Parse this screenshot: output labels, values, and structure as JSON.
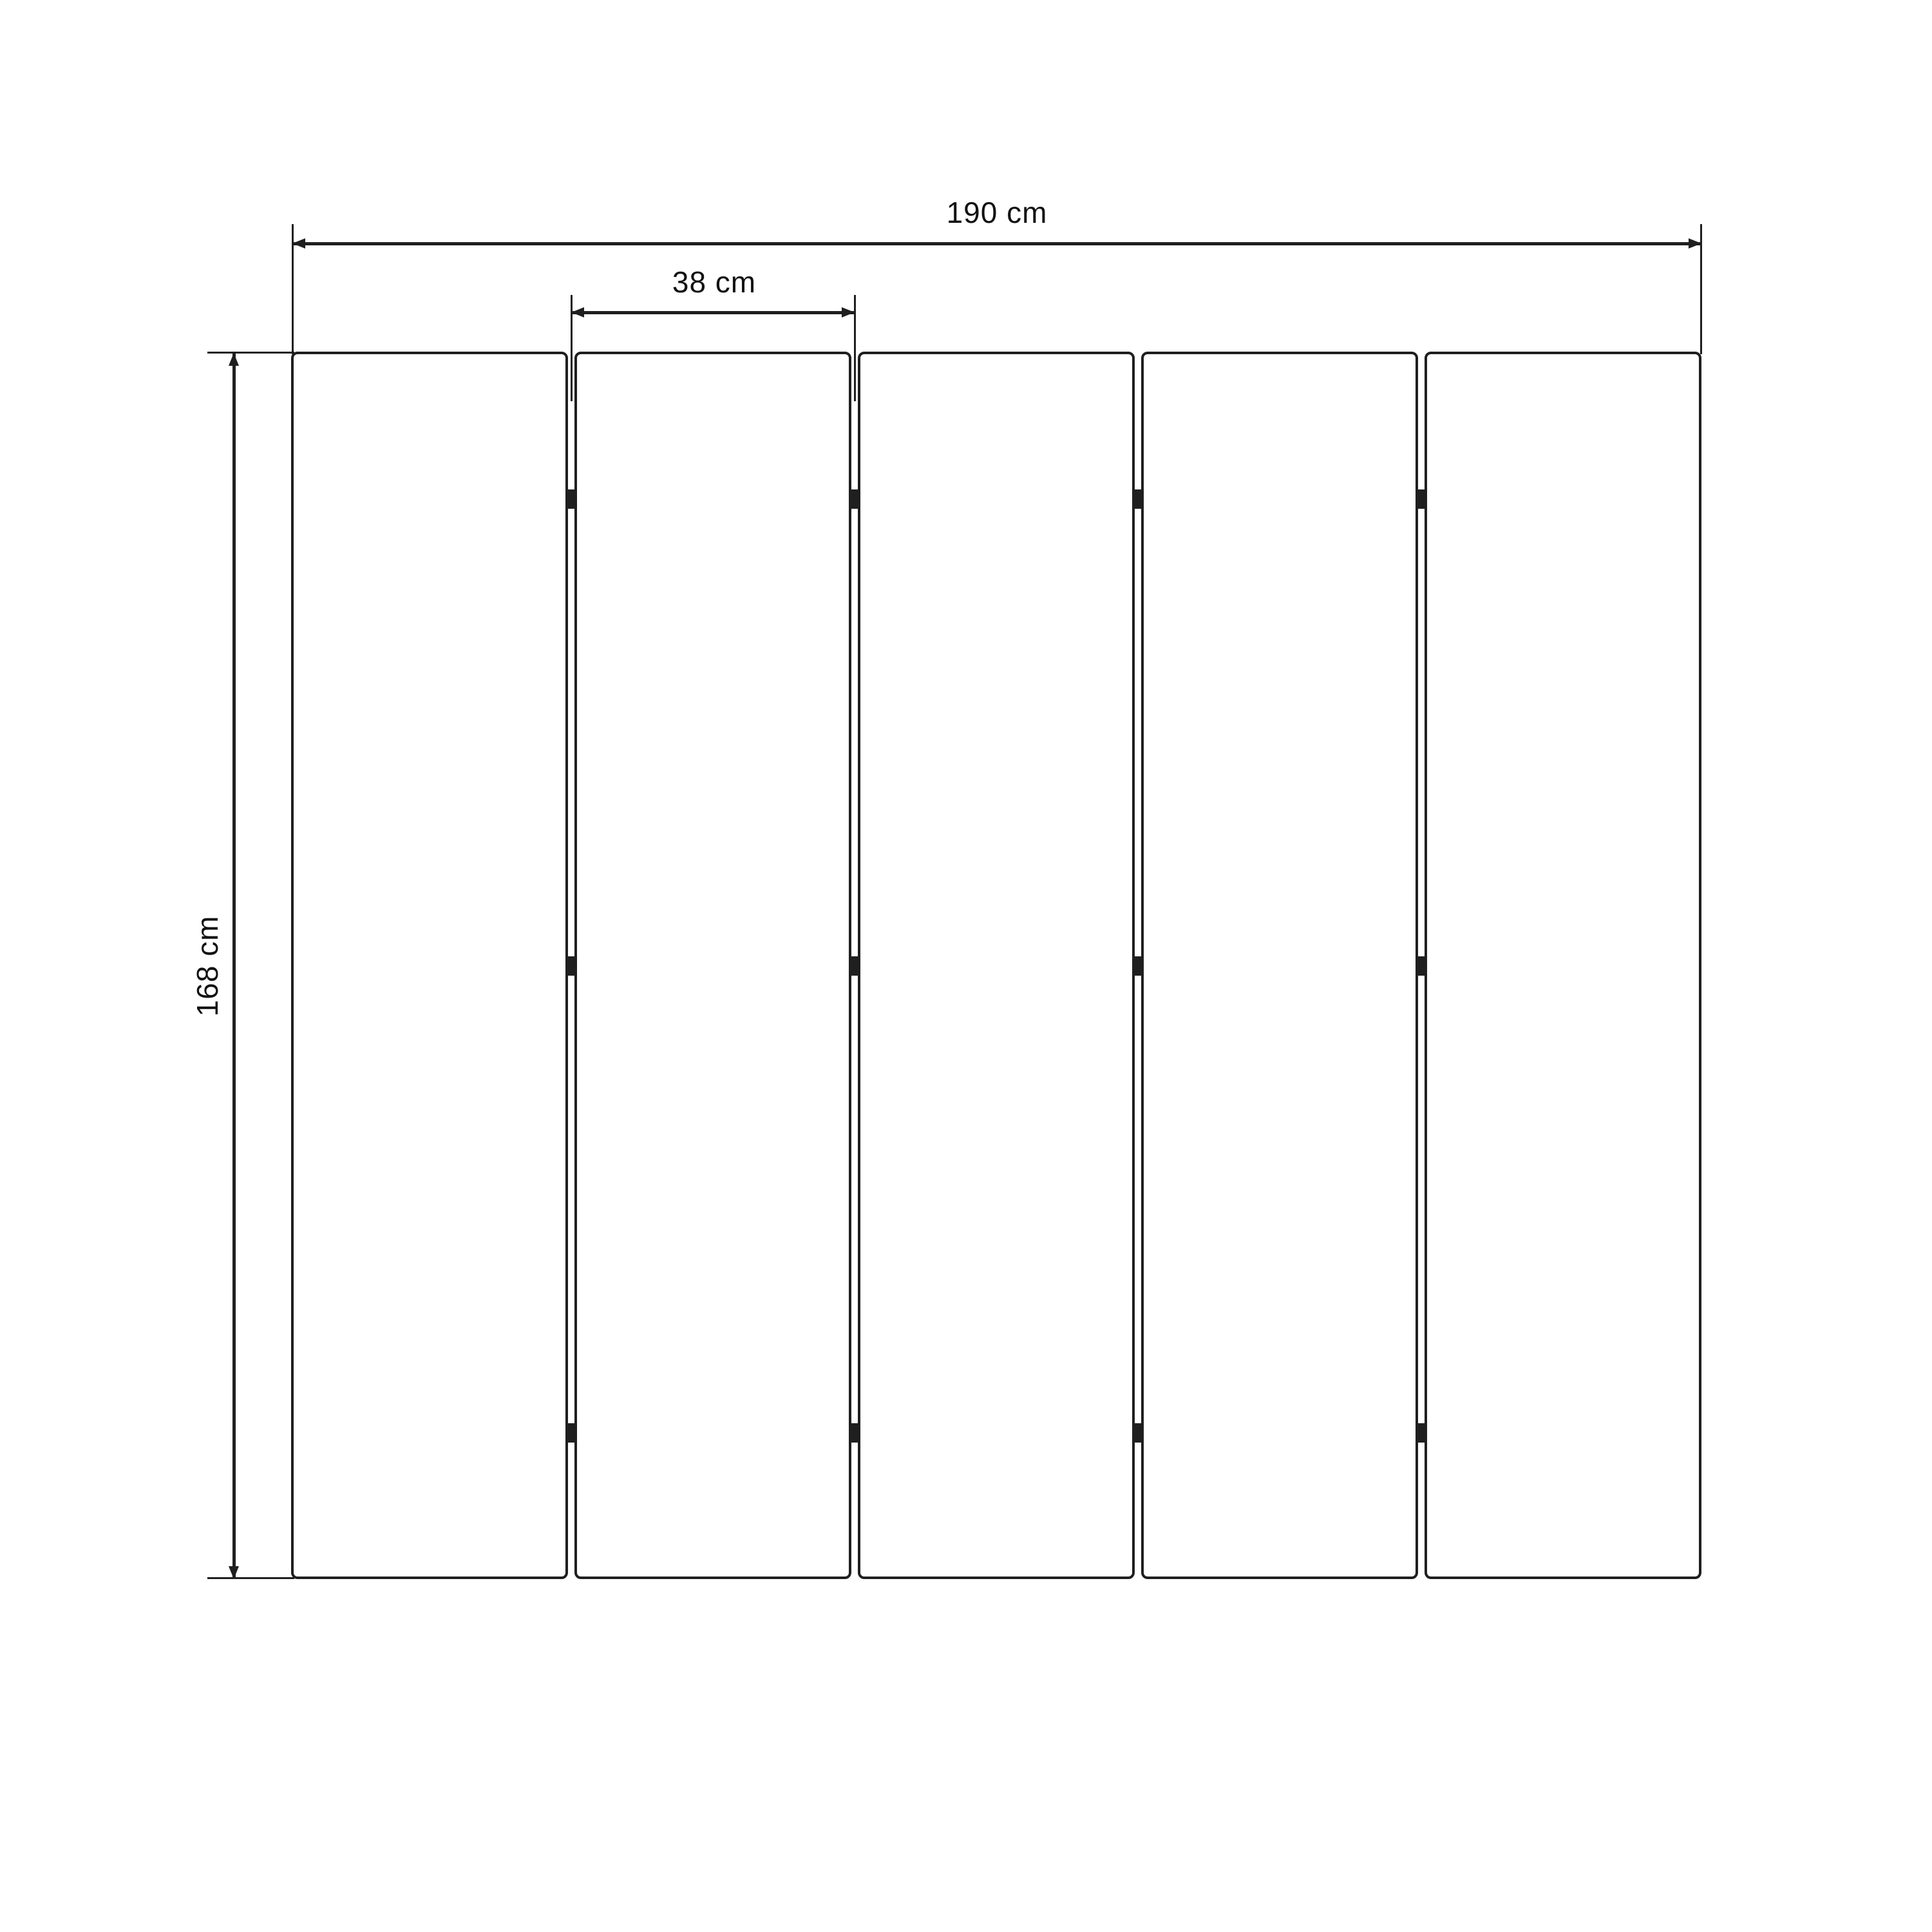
{
  "diagram": {
    "title": "folding-screen-dimension-drawing",
    "background_color": "#ffffff",
    "line_color": "#1f1f1f",
    "text_color": "#121212",
    "panel_count": 5,
    "hinge_rows_per_gap": 3,
    "dimensions": {
      "total_width": {
        "label": "190 cm"
      },
      "panel_width": {
        "label": "38 cm"
      },
      "panel_height": {
        "label": "168 cm"
      }
    }
  }
}
